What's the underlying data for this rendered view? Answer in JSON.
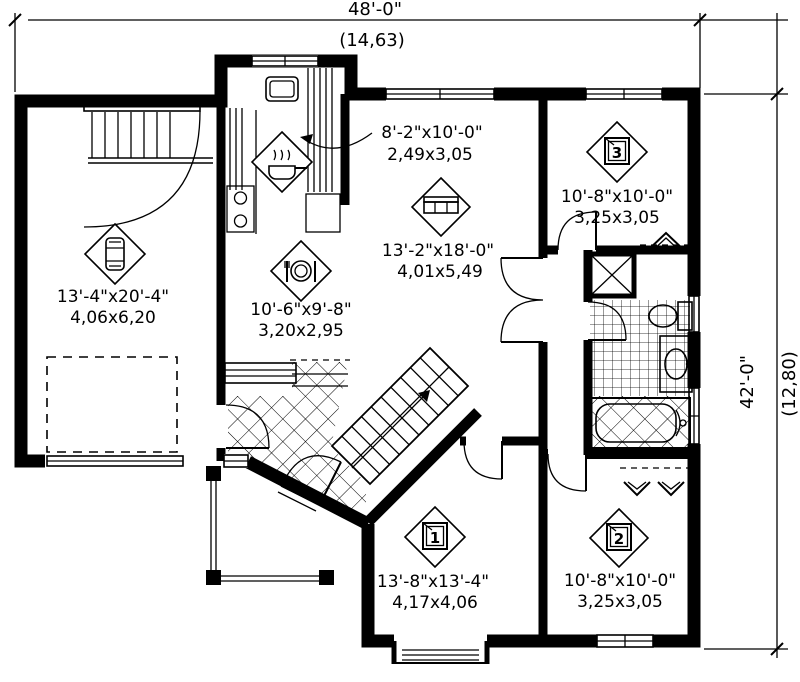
{
  "meta": {
    "drawing_type": "house-floor-plan"
  },
  "colors": {
    "ink": "#000000",
    "paper": "#ffffff"
  },
  "dimensions": {
    "top": {
      "imperial": "48'-0\"",
      "metric": "(14,63)"
    },
    "right": {
      "imperial": "42'-0\"",
      "metric": "(12,80)"
    }
  },
  "rooms": [
    {
      "name": "garage",
      "icon": "car-icon",
      "imperial": "13'-4\"x20'-4\"",
      "metric": "4,06x6,20"
    },
    {
      "name": "kitchen",
      "icon": "cooking-pot-icon",
      "imperial": "8'-2\"x10'-0\"",
      "metric": "2,49x3,05"
    },
    {
      "name": "dining",
      "icon": "place-setting-icon",
      "imperial": "10'-6\"x9'-8\"",
      "metric": "3,20x2,95"
    },
    {
      "name": "living",
      "icon": "sofa-icon",
      "imperial": "13'-2\"x18'-0\"",
      "metric": "4,01x5,49"
    },
    {
      "name": "bedroom-3",
      "icon": "bed-icon",
      "number": "3",
      "imperial": "10'-8\"x10'-0\"",
      "metric": "3,25x3,05"
    },
    {
      "name": "bedroom-1",
      "icon": "bed-icon",
      "number": "1",
      "imperial": "13'-8\"x13'-4\"",
      "metric": "4,17x4,06"
    },
    {
      "name": "bedroom-2",
      "icon": "bed-icon",
      "number": "2",
      "imperial": "10'-8\"x10'-0\"",
      "metric": "3,25x3,05"
    }
  ]
}
